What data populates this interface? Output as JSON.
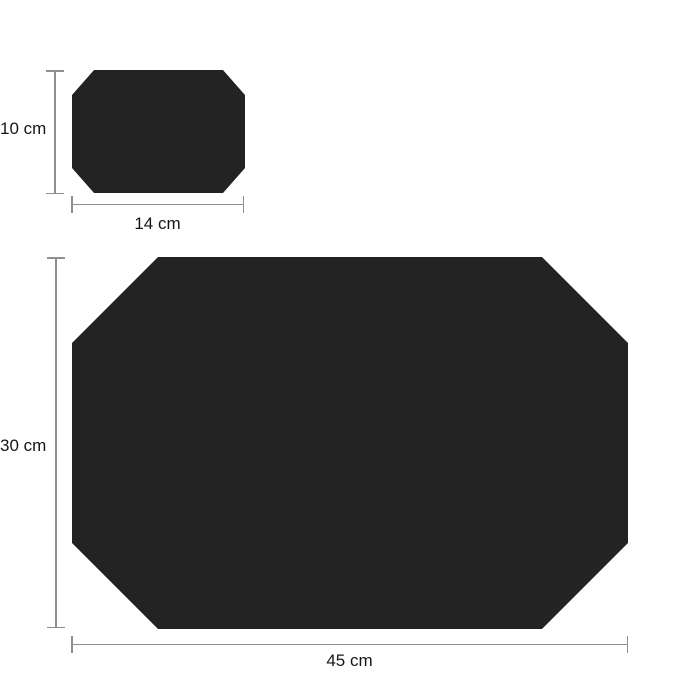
{
  "diagram": {
    "type": "product-dimension-diagram",
    "description": "Two black octagonal placemat shapes shown with height and width dimension lines",
    "items": [
      {
        "id": "small",
        "shape": "octagon",
        "height_label": "10 cm",
        "width_label": "14 cm",
        "height_cm": 10,
        "width_cm": 14
      },
      {
        "id": "large",
        "shape": "octagon",
        "height_label": "30 cm",
        "width_label": "45 cm",
        "height_cm": 30,
        "width_cm": 45
      }
    ]
  },
  "colors": {
    "background": "#ffffff",
    "shape_fill": "#232323",
    "dimension_line": "#8f8f8f",
    "label_text": "#161616"
  }
}
